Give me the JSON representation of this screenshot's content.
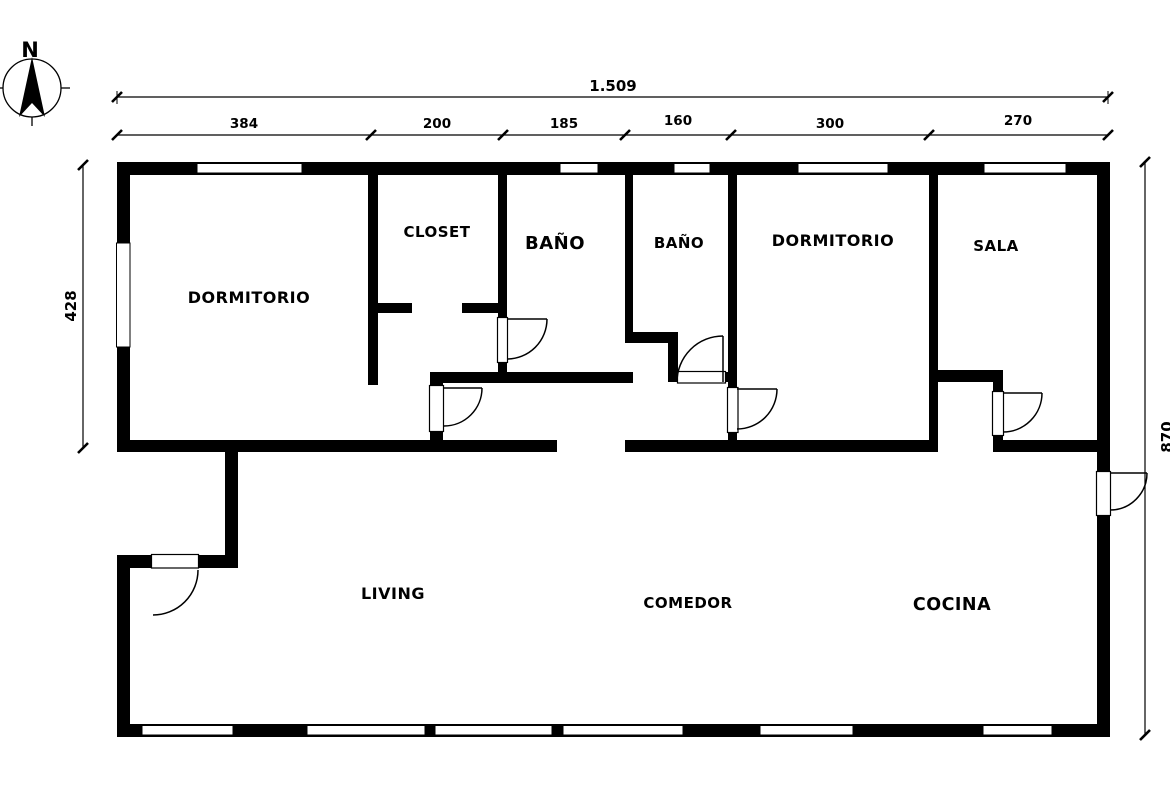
{
  "compass": {
    "north_label": "N"
  },
  "dimensions": {
    "total_width": "1.509",
    "top_segments": [
      "384",
      "200",
      "185",
      "160",
      "300",
      "270"
    ],
    "left_height": "428",
    "right_height": "870"
  },
  "rooms": {
    "dormitorio_1": "DORMITORIO",
    "closet": "CLOSET",
    "bano_1": "BAÑO",
    "bano_2": "BAÑO",
    "dormitorio_2": "DORMITORIO",
    "sala": "SALA",
    "living": "LIVING",
    "comedor": "COMEDOR",
    "cocina": "COCINA"
  },
  "colors": {
    "wall": "#000000",
    "background": "#ffffff"
  }
}
